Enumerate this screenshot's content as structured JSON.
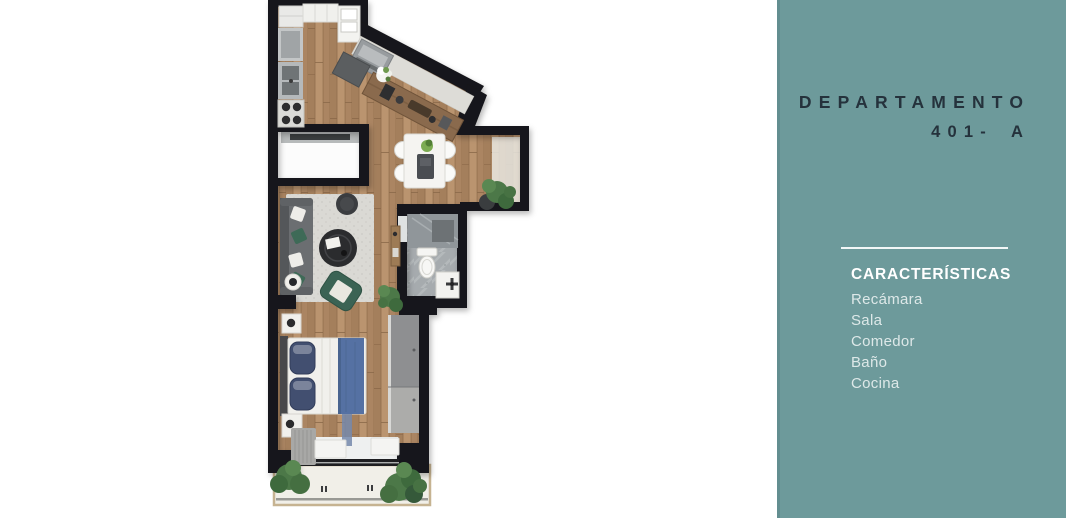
{
  "panel": {
    "title_line1": "DEPARTAMENTO",
    "title_line2": "401- A",
    "section_heading": "CARACTERÍSTICAS",
    "features": [
      "Recámara",
      "Sala",
      "Comedor",
      "Baño",
      "Cocina"
    ],
    "colors": {
      "background": "#6D9A9B",
      "title": "#25323C",
      "heading": "#FFFFFF",
      "feature_text": "#DDE8E8",
      "divider": "#F2F7F7"
    }
  },
  "floor_plan": {
    "colors": {
      "wall": "#17171A",
      "wood": "#B28E6C",
      "rug": "#DAD9D4",
      "tile": "#A6ABAE",
      "balcony_floor": "#F1EFE8",
      "balcony_trim": "#C6B391",
      "plant_green": "#4C7848",
      "bed_blue": "#5571A3",
      "armchair_green": "#3B6354"
    }
  }
}
